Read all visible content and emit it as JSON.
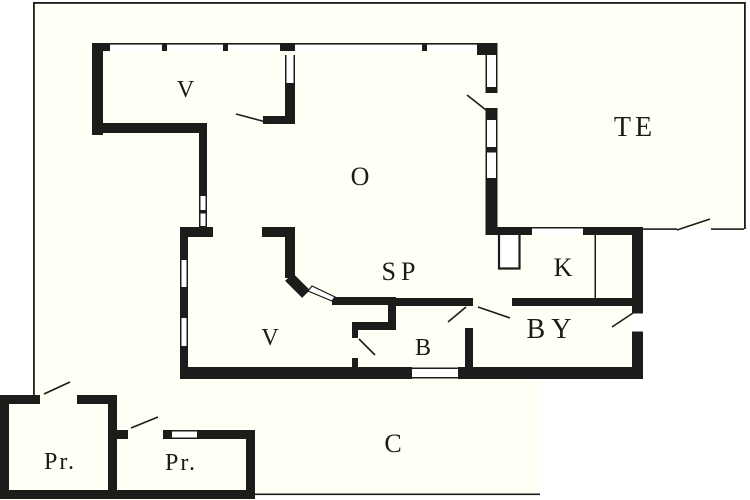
{
  "plan": {
    "title": "floor-plan",
    "rooms": [
      {
        "id": "v-upper",
        "label": "V"
      },
      {
        "id": "o",
        "label": "O"
      },
      {
        "id": "te",
        "label": "TE"
      },
      {
        "id": "sp",
        "label": "SP"
      },
      {
        "id": "k",
        "label": "K"
      },
      {
        "id": "v-lower",
        "label": "V"
      },
      {
        "id": "b",
        "label": "B"
      },
      {
        "id": "by",
        "label": "BY"
      },
      {
        "id": "c",
        "label": "C"
      },
      {
        "id": "pr-1",
        "label": "Pr."
      },
      {
        "id": "pr-2",
        "label": "Pr."
      }
    ],
    "colors": {
      "wall": "#1c1c1a",
      "paper": "#fffff5",
      "outside": "#ffffff",
      "window_fill": "#ffffff"
    }
  }
}
